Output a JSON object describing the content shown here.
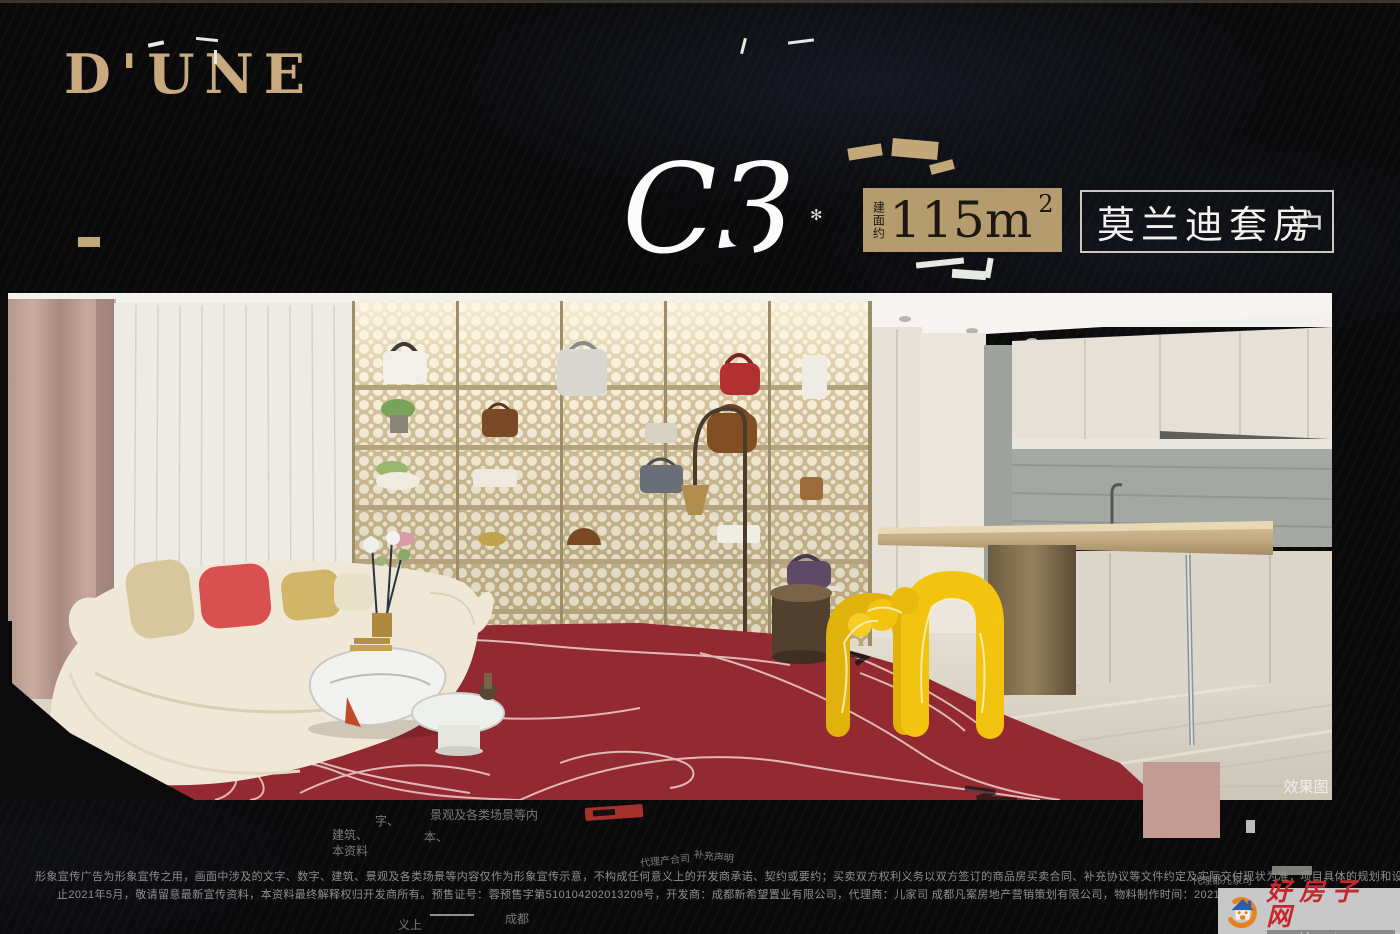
{
  "brand": {
    "logo": "D'UNE"
  },
  "unit": {
    "code": "C3",
    "ornament": "✻"
  },
  "area_badge": {
    "prefix": "建面约",
    "value": "115m",
    "sup": "2"
  },
  "suite": {
    "name": "莫兰迪套房",
    "glitch_char": "户"
  },
  "photo": {
    "caption": "效果图"
  },
  "artifacts": {
    "f1": "字、",
    "f2": "景观及各类场景等内",
    "f3": "建筑、",
    "f4": "本、",
    "f5": "本资料",
    "f6": "代理产合司",
    "f7": "补充声明",
    "f8": "义上",
    "f9": "成都",
    "f10": "代理都儿家司"
  },
  "disclaimer": {
    "line1": "形象宣传广告为形象宣传之用，画面中涉及的文字、数字、建筑、景观及各类场景等内容仅作为形象宣传示意，不构成任何意义上的开发商承诺、契约或要约；买卖双方权利义务以双方签订的商品房买卖合同、补充协议等文件约定及实际交付现状为准；项目具体的规划和设计及本资料涉及的其他相关项目及周边的规划和建设信息以政府最终审批意见为准，开为准，开为准，开",
    "line2": "止2021年5月，敬请留意最新宣传资料，本资料最终解释权归开发商所有。预售证号：蓉预售字第510104202013209号，开发商：成都新希望置业有限公司，代理商：儿家司 成都凡案房地产营销策划有限公司，物料制作时间：2021年5月。"
  },
  "watermark": {
    "site_name": "好房子网",
    "url": "www.hfangziwang.com"
  },
  "colors": {
    "background": "#0a0a0b",
    "brand_gold": "#c9aa7f",
    "badge_bg": "#b49c6e",
    "badge_text": "#1c1712",
    "suite_border": "#ccc7bd",
    "title_white": "#fbfbf9",
    "carpet_red": "#9e2f36",
    "accent_yellow": "#f2c40f",
    "pink_artifact": "#c29b93",
    "watermark_red": "#c5272d",
    "disclaimer_grey": "#8f8f8f"
  }
}
